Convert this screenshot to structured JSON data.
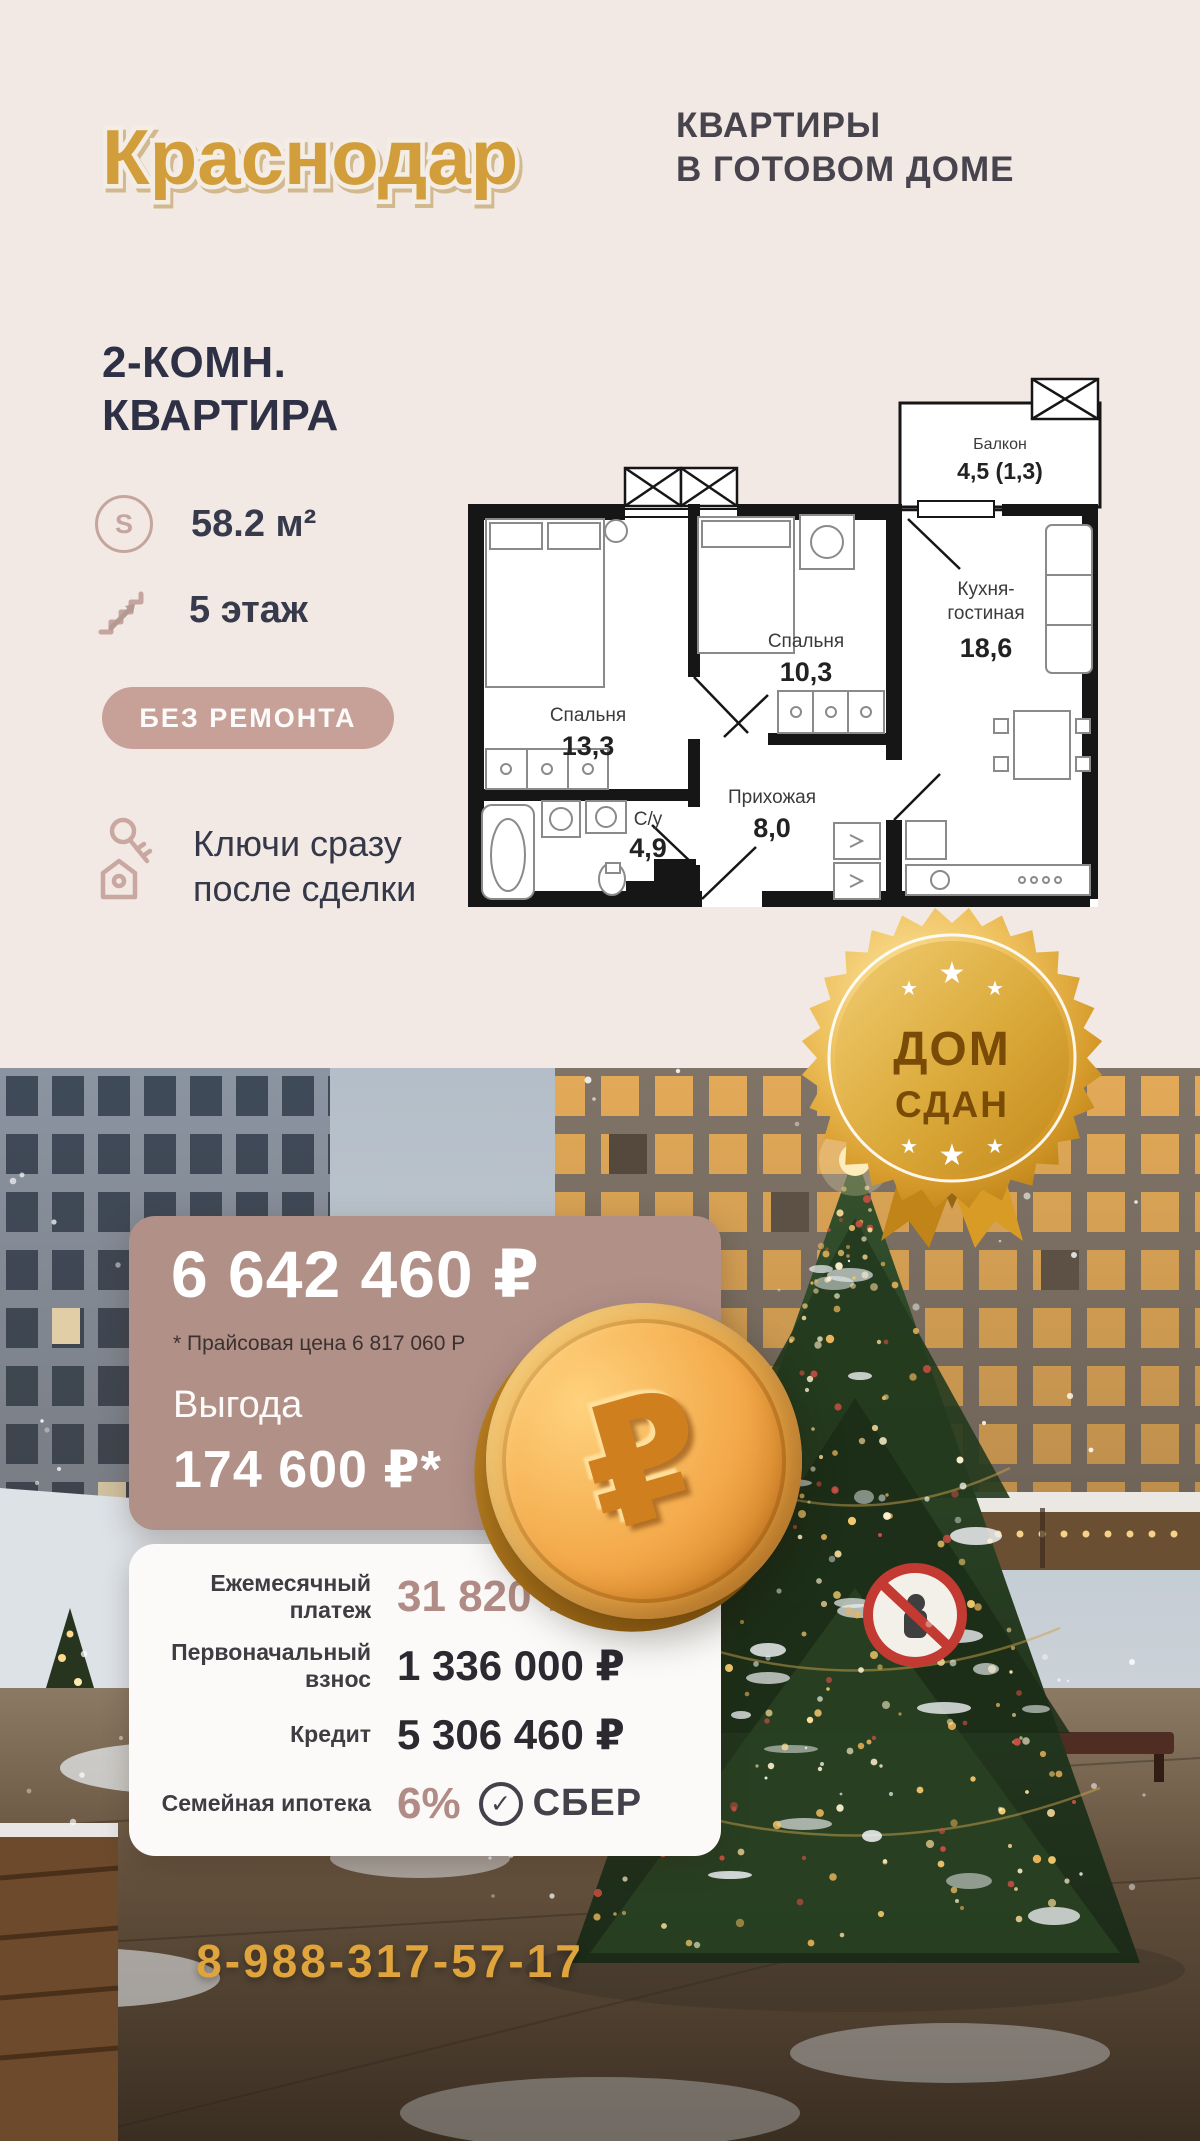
{
  "header": {
    "city": "Краснодар",
    "tagline1": "КВАРТИРЫ",
    "tagline2": "В ГОТОВОМ ДОМЕ"
  },
  "listing": {
    "title1": "2-КОМН.",
    "title2": "КВАРТИРА",
    "area_symbol": "S",
    "area": "58.2 м²",
    "floor": "5 этаж",
    "condition": "БЕЗ РЕМОНТА",
    "keys1": "Ключи сразу",
    "keys2": "после сделки"
  },
  "floorplan": {
    "balcony": {
      "name": "Балкон",
      "area": "4,5 (1,3)"
    },
    "kitchen": {
      "name1": "Кухня-",
      "name2": "гостиная",
      "area": "18,6"
    },
    "bedroom2": {
      "name": "Спальня",
      "area": "10,3"
    },
    "bedroom1": {
      "name": "Спальня",
      "area": "13,3"
    },
    "bath": {
      "name": "С/у",
      "area": "4,9"
    },
    "hall": {
      "name": "Прихожая",
      "area": "8,0"
    }
  },
  "badge": {
    "line1": "ДОМ",
    "line2": "СДАН",
    "star": "★"
  },
  "price": {
    "main": "6 642 460 ₽",
    "note": "* Прайсовая цена 6 817 060 Р",
    "benefit_label": "Выгода",
    "benefit_value": "174 600 ₽*"
  },
  "payments": {
    "monthly_label": "Ежемесячный платеж",
    "monthly_value": "31 820 ₽",
    "initial_label1": "Первоначальный",
    "initial_label2": "взнос",
    "initial_value": "1 336 000 ₽",
    "credit_label": "Кредит",
    "credit_value": "5 306 460 ₽",
    "mortgage_label": "Семейная ипотека",
    "rate": "6%",
    "bank": "СБЕР",
    "bank_check": "✓"
  },
  "coin": {
    "symbol": "₽"
  },
  "contact": {
    "phone": "8-988-317-57-17"
  },
  "colors": {
    "gold": "#d29e3a",
    "rose": "#c7a098",
    "card": "#b19088",
    "navy": "#2f3143",
    "value_rose": "#b18b85",
    "badge_text": "#7a4b06"
  }
}
